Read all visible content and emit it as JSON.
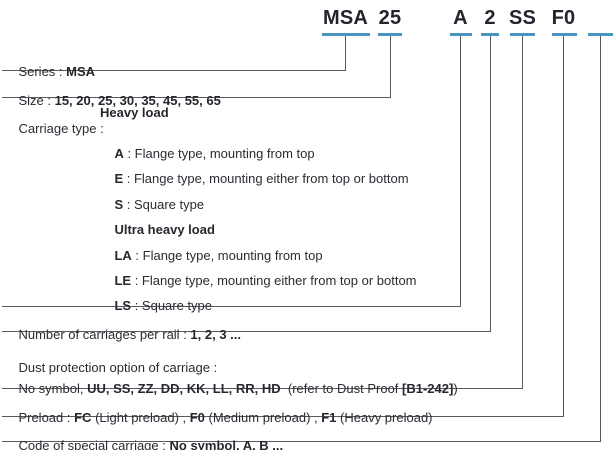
{
  "header": {
    "series_code": "MSA",
    "size_code": "25",
    "carriage_code": "A",
    "count_code": "2",
    "dust_code": "SS",
    "preload_code": "F0",
    "special_code": ""
  },
  "rows": {
    "series": {
      "label": "Series",
      "colon": " : ",
      "value": "MSA"
    },
    "size": {
      "label": "Size",
      "colon": " : ",
      "value": "15, 20, 25, 30, 35, 45, 55, 65"
    },
    "carriage": {
      "label": "Carriage type",
      "colon": " : ",
      "value": "Heavy load"
    },
    "carriage_items": [
      {
        "code": "A",
        "desc": " : Flange type, mounting from top"
      },
      {
        "code": "E",
        "desc": " : Flange type, mounting either from top or bottom"
      },
      {
        "code": "S",
        "desc": " : Square type"
      },
      {
        "code": "Ultra heavy load",
        "desc": ""
      },
      {
        "code": "LA",
        "desc": " : Flange type, mounting from top"
      },
      {
        "code": "LE",
        "desc": " : Flange type, mounting either from top or bottom"
      },
      {
        "code": "LS",
        "desc": " : Square type"
      }
    ],
    "number": {
      "label": "Number of carriages per rail",
      "colon": " : ",
      "value": "1, 2, 3 ..."
    },
    "dust": {
      "label": "Dust protection option of carriage",
      "colon": " :"
    },
    "dust_options": {
      "pre": "No symbol, ",
      "codes": "UU, SS, ZZ, DD, KK, LL, RR, HD",
      "mid": "  (refer to Dust Proof ",
      "ref": "[B1-242]",
      "post": ")"
    },
    "preload": {
      "label": "Preload",
      "colon": " : ",
      "fc": "FC",
      "fc_desc": " (Light preload) , ",
      "f0": "F0",
      "f0_desc": " (Medium preload) , ",
      "f1": "F1",
      "f1_desc": " (Heavy preload)"
    },
    "special": {
      "label": "Code of special carriage",
      "colon": " : ",
      "value": "No symbol, A, B ..."
    }
  },
  "colors": {
    "accent_underline": "#4b94bd",
    "connector_line": "#5a5a5e",
    "text": "#2b2b33"
  }
}
